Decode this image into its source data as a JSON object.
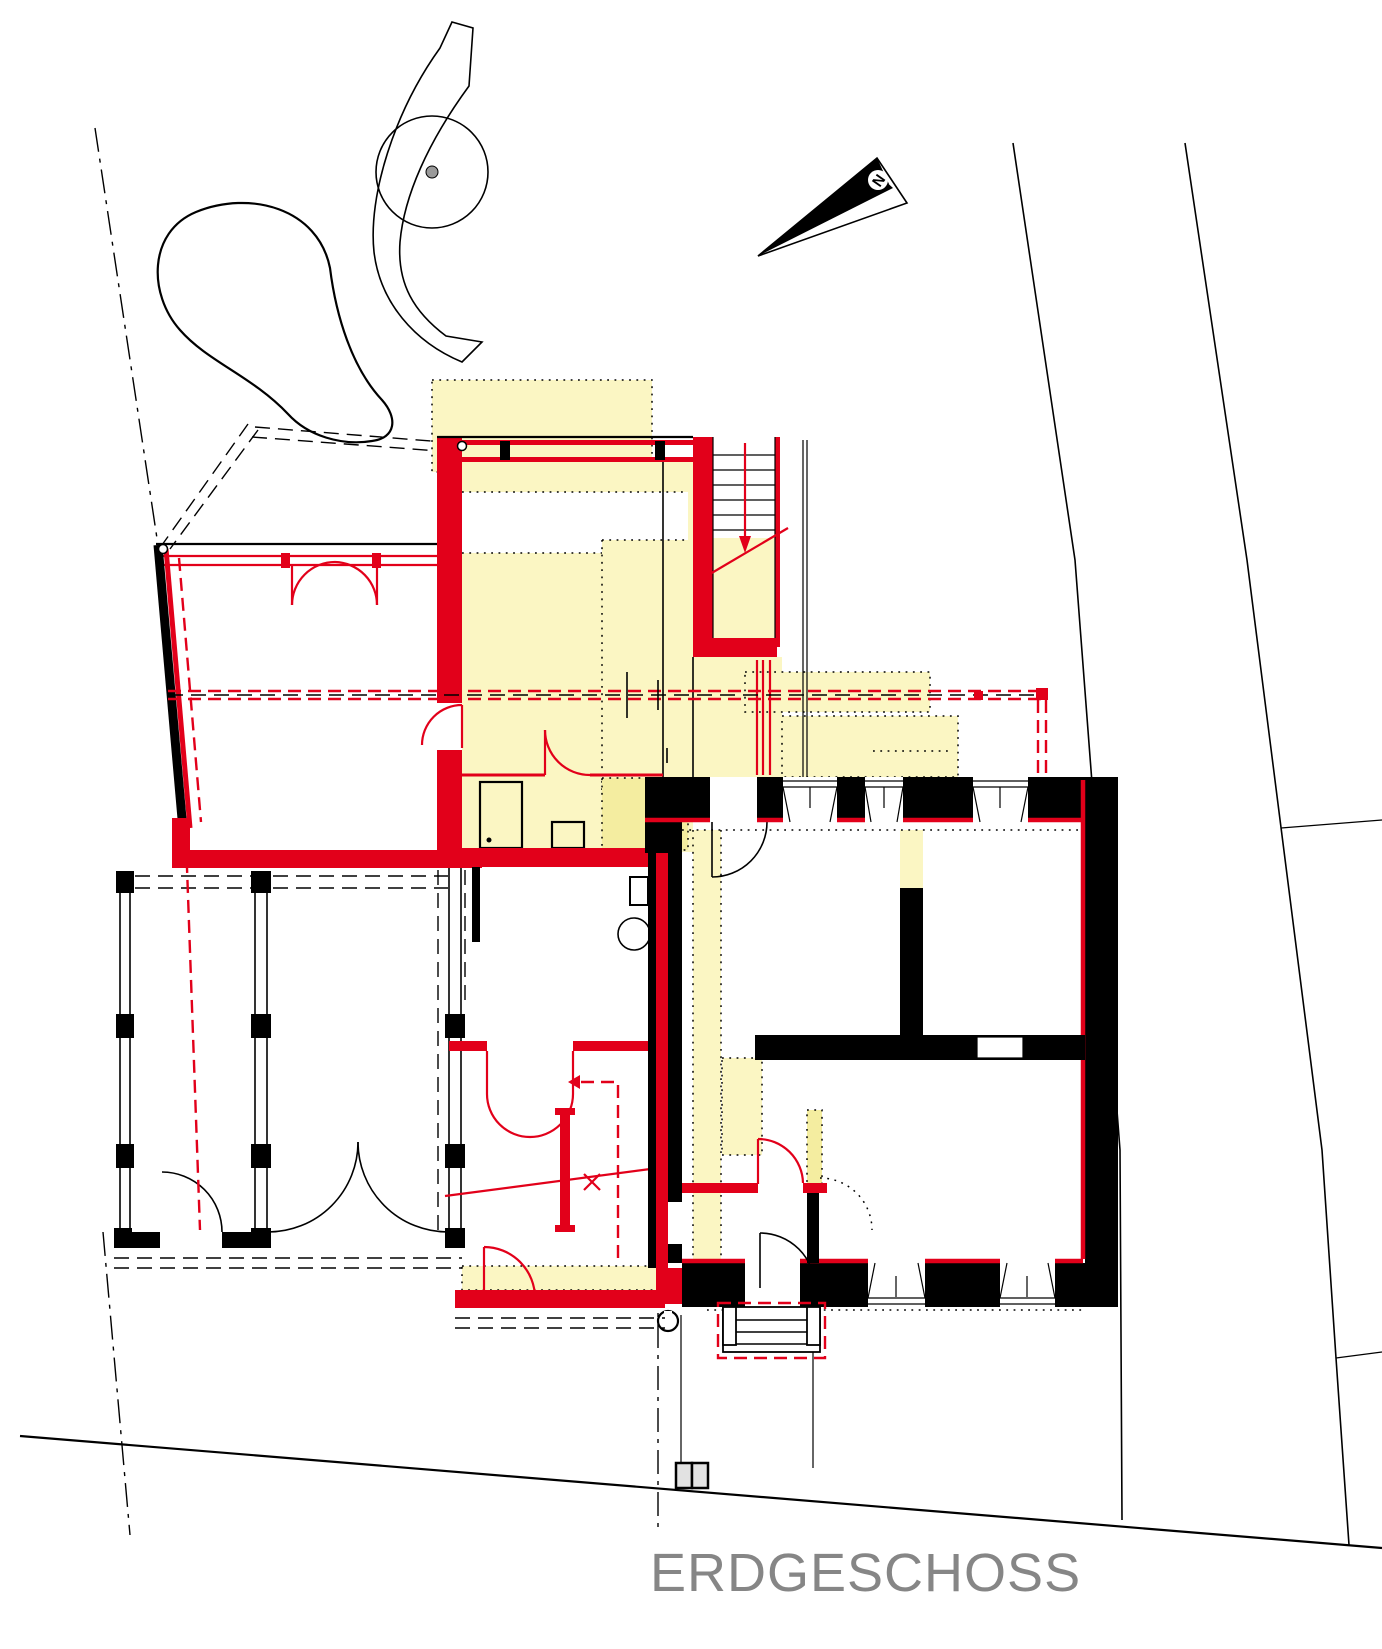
{
  "drawing": {
    "title": "ERDGESCHOSS",
    "compass_label": "N"
  },
  "icons": {
    "north_arrow": "narrow-triangle-pointer",
    "tree": "circle-with-center-dot",
    "entry_stairs": "stepped-treads",
    "stair_direction": "red-down-arrow"
  },
  "colors": {
    "new_construction_red": "#e2001a",
    "highlight_yellow": "#fbf6c3",
    "highlight_yellow_strong": "#f4eda0",
    "landscape_green": "#d9f3d6",
    "landscape_grey": "#ebebeb",
    "existing_black": "#000000",
    "title_grey": "#868686",
    "background": "#ffffff"
  }
}
